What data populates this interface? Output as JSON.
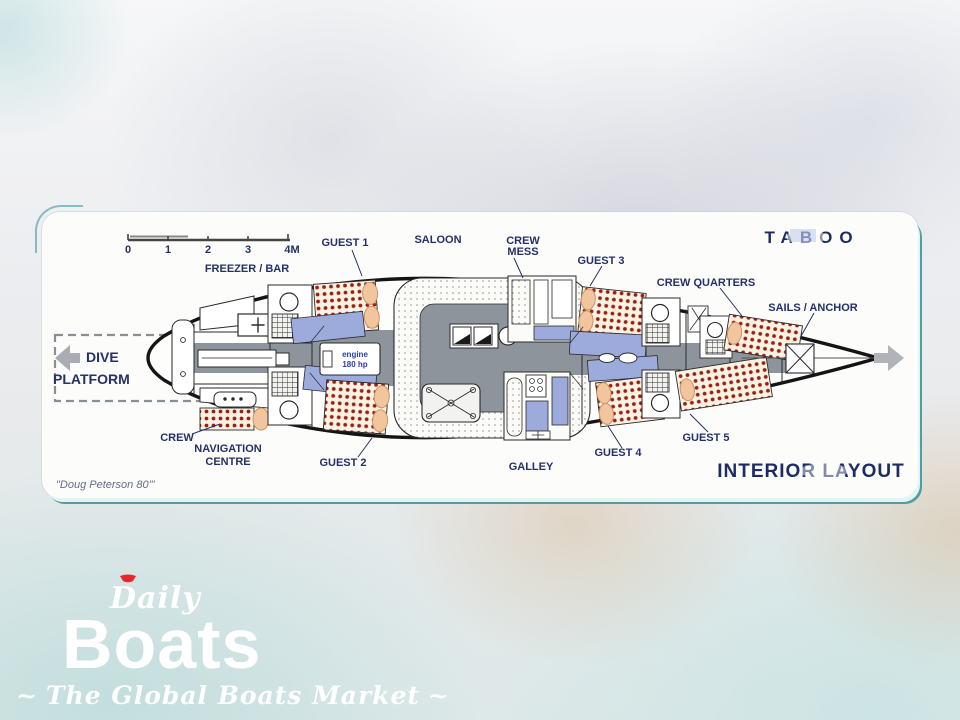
{
  "plan": {
    "boat_name": "TABOO",
    "title": "INTERIOR LAYOUT",
    "signature": "\"Doug Peterson 80'\"",
    "engine": {
      "line1": "engine",
      "line2": "180 hp"
    },
    "scale_ticks": [
      "0",
      "1",
      "2",
      "3",
      "4M"
    ],
    "labels": {
      "freezer_bar": "FREEZER / BAR",
      "guest1": "GUEST 1",
      "saloon": "SALOON",
      "crew_mess_line1": "CREW",
      "crew_mess_line2": "MESS",
      "guest3": "GUEST 3",
      "crew_quarters": "CREW QUARTERS",
      "sails_anchor": "SAILS / ANCHOR",
      "dive_line1": "DIVE",
      "dive_line2": "PLATFORM",
      "crew": "CREW",
      "nav_line1": "NAVIGATION",
      "nav_line2": "CENTRE",
      "guest2": "GUEST 2",
      "galley": "GALLEY",
      "guest4": "GUEST 4",
      "guest5": "GUEST 5"
    },
    "colors": {
      "label_navy": "#253069",
      "bed_dot_red": "#9c1f12",
      "berth_blue": "#9daadc",
      "floor_gray": "#8e949c",
      "hull_black": "#141414",
      "accent_teal": "#4f9ea1"
    }
  },
  "watermark": {
    "brand_script": "Daily",
    "brand_main": "Boats",
    "tagline": "The Global Boats Market",
    "flourish_left": "~",
    "flourish_right": "~",
    "accent_red": "#e8262d"
  }
}
